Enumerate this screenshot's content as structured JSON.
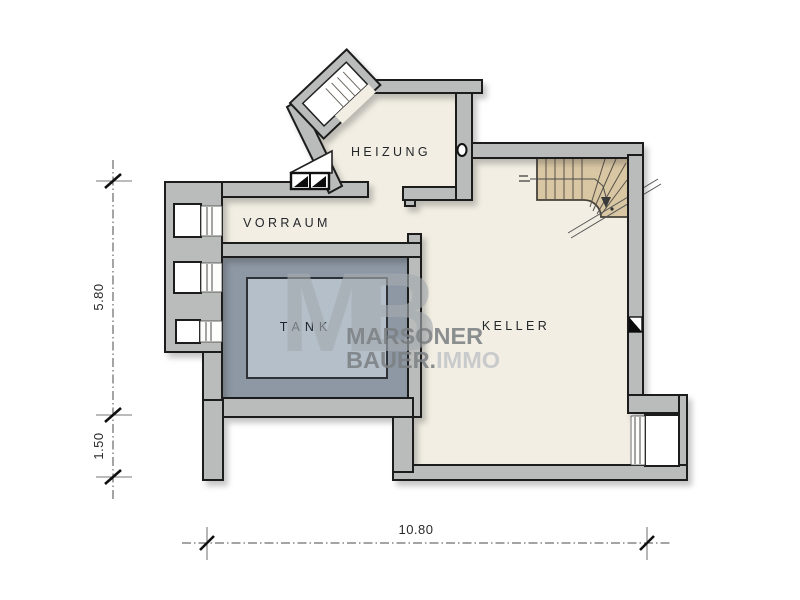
{
  "plan": {
    "rooms": {
      "heizung": "HEIZUNG",
      "vorraum": "VORRAUM",
      "tank": "TANK",
      "keller": "KELLER"
    },
    "dimensions": {
      "left_upper": "5.80",
      "left_lower": "1.50",
      "bottom": "10.80"
    },
    "watermark": {
      "monogram": "MB",
      "line1": "MARSONER",
      "line2_bold": "BAUER.",
      "line2_light": "IMMO"
    },
    "colors": {
      "wall": "#b9bcba",
      "outline": "#1c1c1c",
      "room": "#f2eee3",
      "tank_outer": "#8d98a4",
      "tank_inner": "#b4bfc9",
      "stairs": "#d9c7a3",
      "wm_mono": "#a6abb0",
      "wm_dark": "#7c8184",
      "wm_light": "#c3c6c9"
    }
  }
}
